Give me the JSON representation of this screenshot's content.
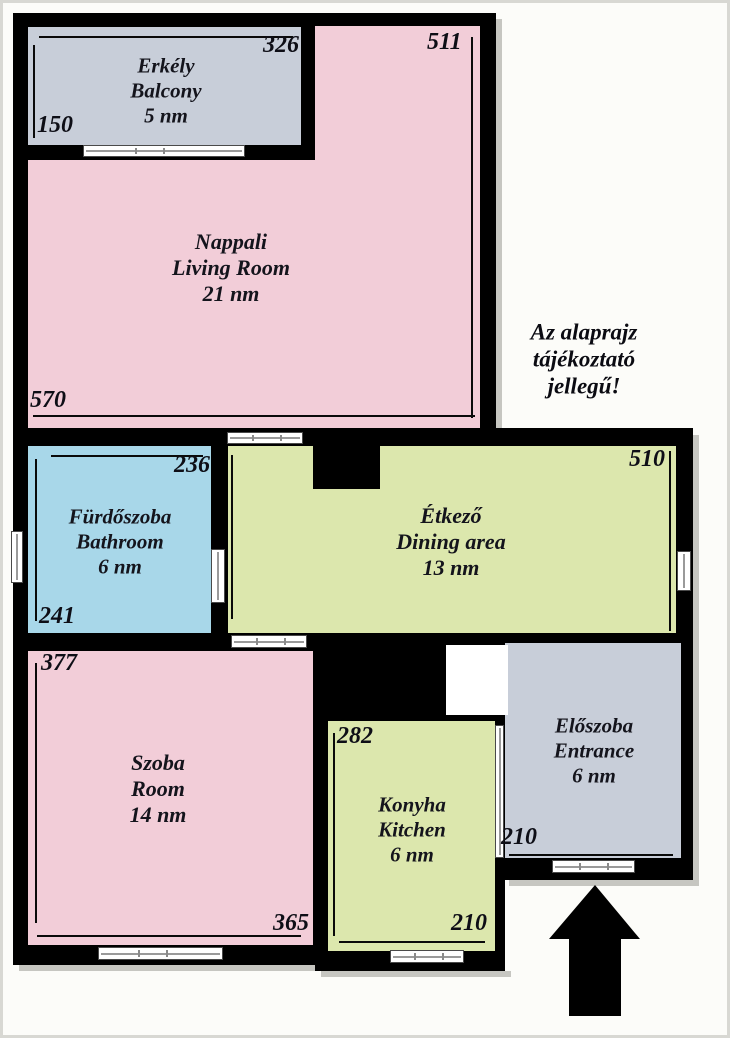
{
  "title": "Alaprajz / Floor plan",
  "note": {
    "line1": "Az alaprajz",
    "line2": "tájékoztató",
    "line3": "jellegű!"
  },
  "rooms": {
    "balcony": {
      "hu": "Erkély",
      "en": "Balcony",
      "area": "5 nm"
    },
    "living": {
      "hu": "Nappali",
      "en": "Living Room",
      "area": "21 nm"
    },
    "bathroom": {
      "hu": "Fürdőszoba",
      "en": "Bathroom",
      "area": "6 nm"
    },
    "dining": {
      "hu": "Étkező",
      "en": "Dining area",
      "area": "13 nm"
    },
    "room": {
      "hu": "Szoba",
      "en": "Room",
      "area": "14 nm"
    },
    "kitchen": {
      "hu": "Konyha",
      "en": "Kitchen",
      "area": "6 nm"
    },
    "entrance": {
      "hu": "Előszoba",
      "en": "Entrance",
      "area": "6 nm"
    }
  },
  "dims": {
    "balcony_width": "326",
    "balcony_depth": "150",
    "living_height": "511",
    "living_width": "570",
    "bathroom_width": "236",
    "bathroom_height": "241",
    "dining_width": "510",
    "room_height": "377",
    "room_width": "365",
    "kitchen_height": "282",
    "kitchen_width": "210",
    "entrance_width": "210"
  },
  "colors": {
    "wall": "#000000",
    "pink_room": "#f2cdd8",
    "green_room": "#dce7ad",
    "blue_room": "#a8d7e9",
    "gray_room": "#c8ced9",
    "shadow": "#c6c6c1"
  }
}
